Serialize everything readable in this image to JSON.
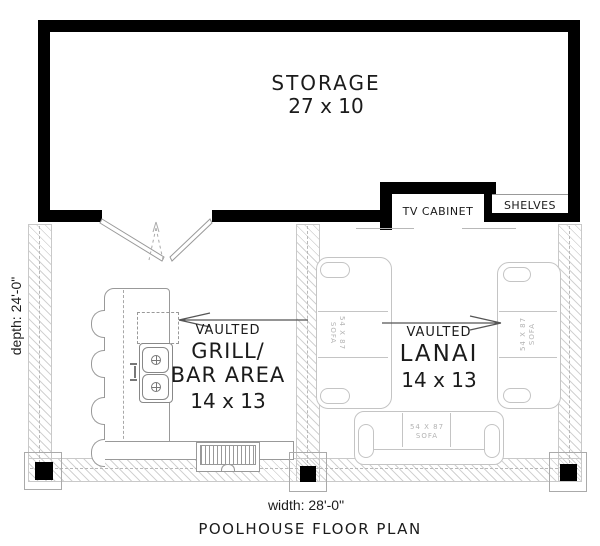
{
  "plan": {
    "title": "POOLHOUSE FLOOR PLAN",
    "dimensions": {
      "width_label": "width: 28'-0\"",
      "depth_label": "depth: 24'-0\""
    },
    "rooms": {
      "storage": {
        "name": "STORAGE",
        "size": "27 x 10"
      },
      "grill_bar": {
        "qualifier": "VAULTED",
        "name_line1": "GRILL/",
        "name_line2": "BAR AREA",
        "size": "14 x 13"
      },
      "lanai": {
        "qualifier": "VAULTED",
        "name": "LANAI",
        "size": "14 x 13"
      }
    },
    "features": {
      "tv_cabinet": "TV CABINET",
      "shelves": "SHELVES"
    },
    "sofas": [
      {
        "size": "54 X 87",
        "label": "SOFA",
        "position": "lanai-left-wall"
      },
      {
        "size": "54 X 87",
        "label": "SOFA",
        "position": "lanai-right-wall"
      },
      {
        "size": "54 X 87",
        "label": "SOFA",
        "position": "lanai-bottom"
      }
    ],
    "colors": {
      "wall": "#000000",
      "furniture_line": "#999999",
      "light_line": "#c4c4c4",
      "hatch_line": "#d2d2d2",
      "label_text": "#1b1b1b",
      "sofa_text": "#b3b3b3"
    }
  }
}
